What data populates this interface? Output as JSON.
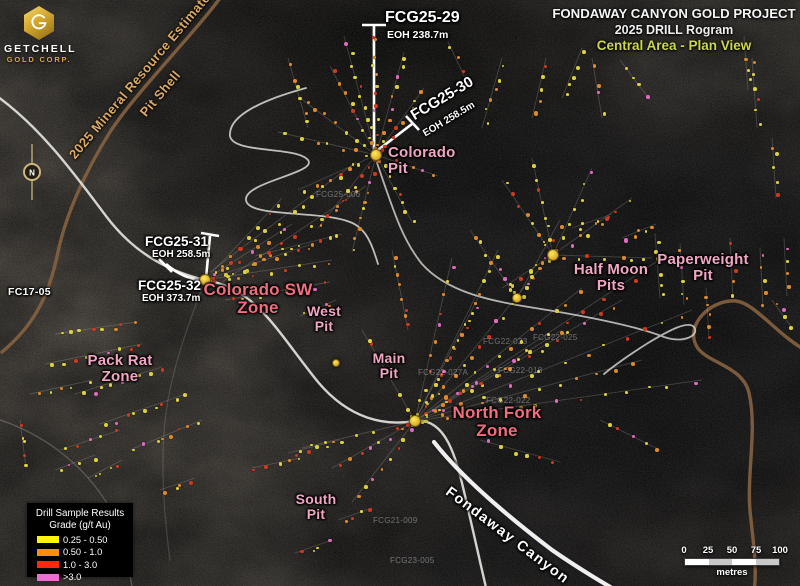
{
  "branding": {
    "logo_monogram": "G",
    "company": "GETCHELL",
    "division": "GOLD CORP.",
    "gold_color": "#d9a93c"
  },
  "title_block": {
    "line1": "FONDAWAY CANYON GOLD PROJECT",
    "line2": "2025 DRILL Rogram",
    "line3": "Central Area - Plan View",
    "line3_color": "#ccd64b"
  },
  "pit_shell_annotation": {
    "line1": "2025 Mineral Resource Estimate",
    "line2": "Pit Shell",
    "color": "#dca963"
  },
  "compass": {
    "north_label": "N"
  },
  "drill_hole_callouts": [
    {
      "name": "FCG25-29",
      "eoh": "EOH 238.7m"
    },
    {
      "name": "FCG25-30",
      "eoh": "EOH 258.5m"
    },
    {
      "name": "FCG25-31",
      "eoh": "EOH 258.5m"
    },
    {
      "name": "FCG25-32",
      "eoh": "EOH 373.7m"
    }
  ],
  "historic_hole_label": "FC17-05",
  "canyon_label": "Fondaway Canyon",
  "label_colors": {
    "pit": "#f2a6c4",
    "zone": "#f26e7f"
  },
  "area_labels": [
    {
      "id": "colorado-pit",
      "text": "Colorado\nPit",
      "x": 388,
      "y": 145,
      "style": "pit",
      "size": 15,
      "align": "left"
    },
    {
      "id": "half-moon-pits",
      "text": "Half Moon\nPits",
      "x": 611,
      "y": 262,
      "style": "pit",
      "size": 15,
      "align": "center"
    },
    {
      "id": "paperweight-pit",
      "text": "Paperweight\nPit",
      "x": 703,
      "y": 252,
      "style": "pit",
      "size": 15,
      "align": "center"
    },
    {
      "id": "colorado-sw-zone",
      "text": "Colorado SW\nZone",
      "x": 258,
      "y": 281,
      "style": "zone",
      "size": 17,
      "align": "center"
    },
    {
      "id": "west-pit",
      "text": "West\nPit",
      "x": 324,
      "y": 304,
      "style": "pit",
      "size": 14,
      "align": "center"
    },
    {
      "id": "main-pit",
      "text": "Main\nPit",
      "x": 389,
      "y": 351,
      "style": "pit",
      "size": 14,
      "align": "center"
    },
    {
      "id": "pack-rat-zone",
      "text": "Pack Rat\nZone",
      "x": 120,
      "y": 353,
      "style": "pit",
      "size": 15,
      "align": "center"
    },
    {
      "id": "north-fork-zone",
      "text": "North Fork\nZone",
      "x": 497,
      "y": 404,
      "style": "zone",
      "size": 17,
      "align": "center"
    },
    {
      "id": "south-pit",
      "text": "South\nPit",
      "x": 316,
      "y": 492,
      "style": "pit",
      "size": 14,
      "align": "center"
    }
  ],
  "faint_hole_ids": [
    {
      "text": "FCG22-018",
      "x": 498,
      "y": 366
    },
    {
      "text": "FCG22-022",
      "x": 486,
      "y": 396
    },
    {
      "text": "FCG22-027A",
      "x": 418,
      "y": 368
    },
    {
      "text": "FCG22-023",
      "x": 483,
      "y": 337
    },
    {
      "text": "FCG22-025",
      "x": 533,
      "y": 333
    },
    {
      "text": "FCG21-009",
      "x": 373,
      "y": 516
    },
    {
      "text": "FCG23-005",
      "x": 390,
      "y": 556
    },
    {
      "text": "FCG25-006",
      "x": 316,
      "y": 190
    }
  ],
  "legend": {
    "title_line1": "Drill Sample Results",
    "title_line2": "Grade (g/t Au)",
    "items": [
      {
        "label": "0.25 - 0.50",
        "color": "#fdf303"
      },
      {
        "label": "0.50 -  1.0",
        "color": "#fd8d05"
      },
      {
        "label": "1.0   -  3.0",
        "color": "#fa2a0c"
      },
      {
        "label": ">3.0",
        "color": "#ea6fd3"
      }
    ]
  },
  "scale_bar": {
    "ticks": [
      "0",
      "25",
      "50",
      "75",
      "100"
    ],
    "unit": "metres"
  },
  "map_data": {
    "dot_palette": {
      "colors": [
        "#ddd23e",
        "#de8a2c",
        "#cd3a20",
        "#e06cc0"
      ],
      "weights": [
        0.46,
        0.25,
        0.19,
        0.1
      ]
    },
    "collars": [
      [
        376,
        155,
        5
      ],
      [
        205,
        280,
        5
      ],
      [
        415,
        421,
        5
      ],
      [
        553,
        255,
        5
      ],
      [
        517,
        298,
        4
      ],
      [
        336,
        363,
        3
      ]
    ],
    "traces": [
      [
        376,
        155,
        344,
        36,
        11
      ],
      [
        376,
        155,
        372,
        28,
        13
      ],
      [
        376,
        155,
        404,
        52,
        10
      ],
      [
        376,
        155,
        424,
        88,
        8
      ],
      [
        376,
        155,
        330,
        66,
        9
      ],
      [
        376,
        155,
        300,
        98,
        8
      ],
      [
        376,
        155,
        278,
        132,
        7
      ],
      [
        376,
        155,
        318,
        228,
        9
      ],
      [
        376,
        155,
        352,
        252,
        10
      ],
      [
        376,
        155,
        298,
        190,
        7
      ],
      [
        376,
        155,
        412,
        222,
        8
      ],
      [
        376,
        155,
        438,
        176,
        6
      ],
      [
        392,
        250,
        408,
        330,
        8
      ],
      [
        482,
        128,
        502,
        58,
        6
      ],
      [
        532,
        118,
        546,
        58,
        5
      ],
      [
        562,
        98,
        582,
        48,
        5
      ],
      [
        602,
        118,
        592,
        58,
        4
      ],
      [
        448,
        42,
        468,
        84,
        4
      ],
      [
        308,
        128,
        288,
        58,
        6
      ],
      [
        620,
        60,
        650,
        100,
        4
      ],
      [
        752,
        58,
        757,
        128,
        6
      ],
      [
        772,
        138,
        776,
        198,
        5
      ],
      [
        744,
        36,
        748,
        90,
        4
      ],
      [
        205,
        280,
        292,
        224,
        9
      ],
      [
        205,
        280,
        312,
        244,
        10
      ],
      [
        205,
        280,
        332,
        260,
        9
      ],
      [
        205,
        280,
        282,
        198,
        8
      ],
      [
        255,
        256,
        342,
        234,
        9
      ],
      [
        225,
        300,
        330,
        282,
        8
      ],
      [
        210,
        272,
        356,
        162,
        12
      ],
      [
        222,
        282,
        366,
        186,
        11
      ],
      [
        300,
        316,
        336,
        300,
        4
      ],
      [
        55,
        334,
        136,
        322,
        8
      ],
      [
        45,
        364,
        142,
        344,
        9
      ],
      [
        75,
        394,
        162,
        367,
        9
      ],
      [
        100,
        424,
        186,
        394,
        9
      ],
      [
        130,
        450,
        202,
        420,
        8
      ],
      [
        30,
        394,
        92,
        380,
        5
      ],
      [
        60,
        450,
        120,
        430,
        5
      ],
      [
        20,
        420,
        26,
        468,
        5
      ],
      [
        88,
        478,
        122,
        460,
        4
      ],
      [
        415,
        421,
        498,
        250,
        15
      ],
      [
        415,
        421,
        540,
        268,
        15
      ],
      [
        415,
        421,
        582,
        288,
        15
      ],
      [
        415,
        421,
        622,
        300,
        14
      ],
      [
        415,
        421,
        662,
        258,
        14
      ],
      [
        415,
        421,
        692,
        310,
        14
      ],
      [
        415,
        421,
        642,
        360,
        12
      ],
      [
        415,
        421,
        702,
        380,
        13
      ],
      [
        415,
        421,
        562,
        330,
        12
      ],
      [
        415,
        421,
        478,
        298,
        11
      ],
      [
        415,
        421,
        452,
        258,
        11
      ],
      [
        517,
        298,
        560,
        220,
        8
      ],
      [
        517,
        298,
        470,
        230,
        8
      ],
      [
        415,
        421,
        332,
        468,
        8
      ],
      [
        415,
        421,
        302,
        448,
        7
      ],
      [
        415,
        421,
        352,
        502,
        8
      ],
      [
        415,
        421,
        362,
        330,
        8
      ],
      [
        480,
        440,
        560,
        462,
        6
      ],
      [
        600,
        420,
        660,
        450,
        5
      ],
      [
        553,
        255,
        502,
        180,
        8
      ],
      [
        553,
        255,
        532,
        158,
        8
      ],
      [
        553,
        255,
        592,
        168,
        7
      ],
      [
        553,
        255,
        632,
        198,
        8
      ],
      [
        553,
        255,
        652,
        258,
        7
      ],
      [
        553,
        255,
        502,
        288,
        7
      ],
      [
        572,
        228,
        612,
        214,
        5
      ],
      [
        622,
        238,
        656,
        224,
        5
      ],
      [
        655,
        233,
        660,
        298,
        6
      ],
      [
        680,
        243,
        684,
        305,
        6
      ],
      [
        706,
        288,
        709,
        338,
        5
      ],
      [
        730,
        238,
        733,
        298,
        5
      ],
      [
        760,
        248,
        763,
        308,
        5
      ],
      [
        784,
        238,
        787,
        296,
        4
      ],
      [
        772,
        300,
        792,
        328,
        4
      ],
      [
        288,
        453,
        340,
        440,
        6
      ],
      [
        252,
        468,
        300,
        458,
        5
      ],
      [
        295,
        553,
        332,
        540,
        4
      ],
      [
        338,
        520,
        372,
        508,
        4
      ],
      [
        160,
        490,
        195,
        478,
        4
      ],
      [
        55,
        470,
        95,
        455,
        4
      ]
    ]
  }
}
